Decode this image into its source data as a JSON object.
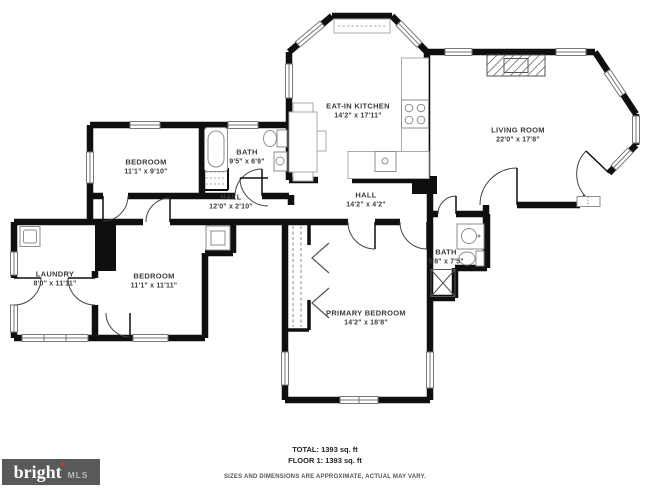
{
  "rooms": {
    "kitchen": {
      "name": "EAT-IN KITCHEN",
      "dims": "14'2\" x 17'11\""
    },
    "living": {
      "name": "LIVING ROOM",
      "dims": "22'0\" x 17'8\""
    },
    "bedroom1": {
      "name": "BEDROOM",
      "dims": "11'1\" x 9'10\""
    },
    "bath1": {
      "name": "BATH",
      "dims": "9'5\" x 6'9\""
    },
    "hall1": {
      "name": "HALL",
      "dims": "12'0\" x 2'10\""
    },
    "hall2": {
      "name": "HALL",
      "dims": "14'2\" x 4'2\""
    },
    "laundry": {
      "name": "LAUNDRY",
      "dims": "8'0\" x 11'11\""
    },
    "bedroom2": {
      "name": "BEDROOM",
      "dims": "11'1\" x 11'11\""
    },
    "primary": {
      "name": "PRIMARY BEDROOM",
      "dims": "14'2\" x 18'8\""
    },
    "bath2": {
      "name": "BATH",
      "dims": "5'8\" x 7'5\""
    }
  },
  "footer": {
    "total": "TOTAL: 1393 sq. ft",
    "floor": "FLOOR 1: 1393 sq. ft",
    "disclaimer": "SIZES AND DIMENSIONS ARE APPROXIMATE, ACTUAL MAY VARY."
  },
  "logo": {
    "brand": "bright",
    "suffix": "MLS",
    "bg_color": "#58595b",
    "accent_color": "#c23b31"
  },
  "colors": {
    "wall": "#0f0f0f",
    "fixture": "#8e8e8e",
    "window": "#777777"
  }
}
